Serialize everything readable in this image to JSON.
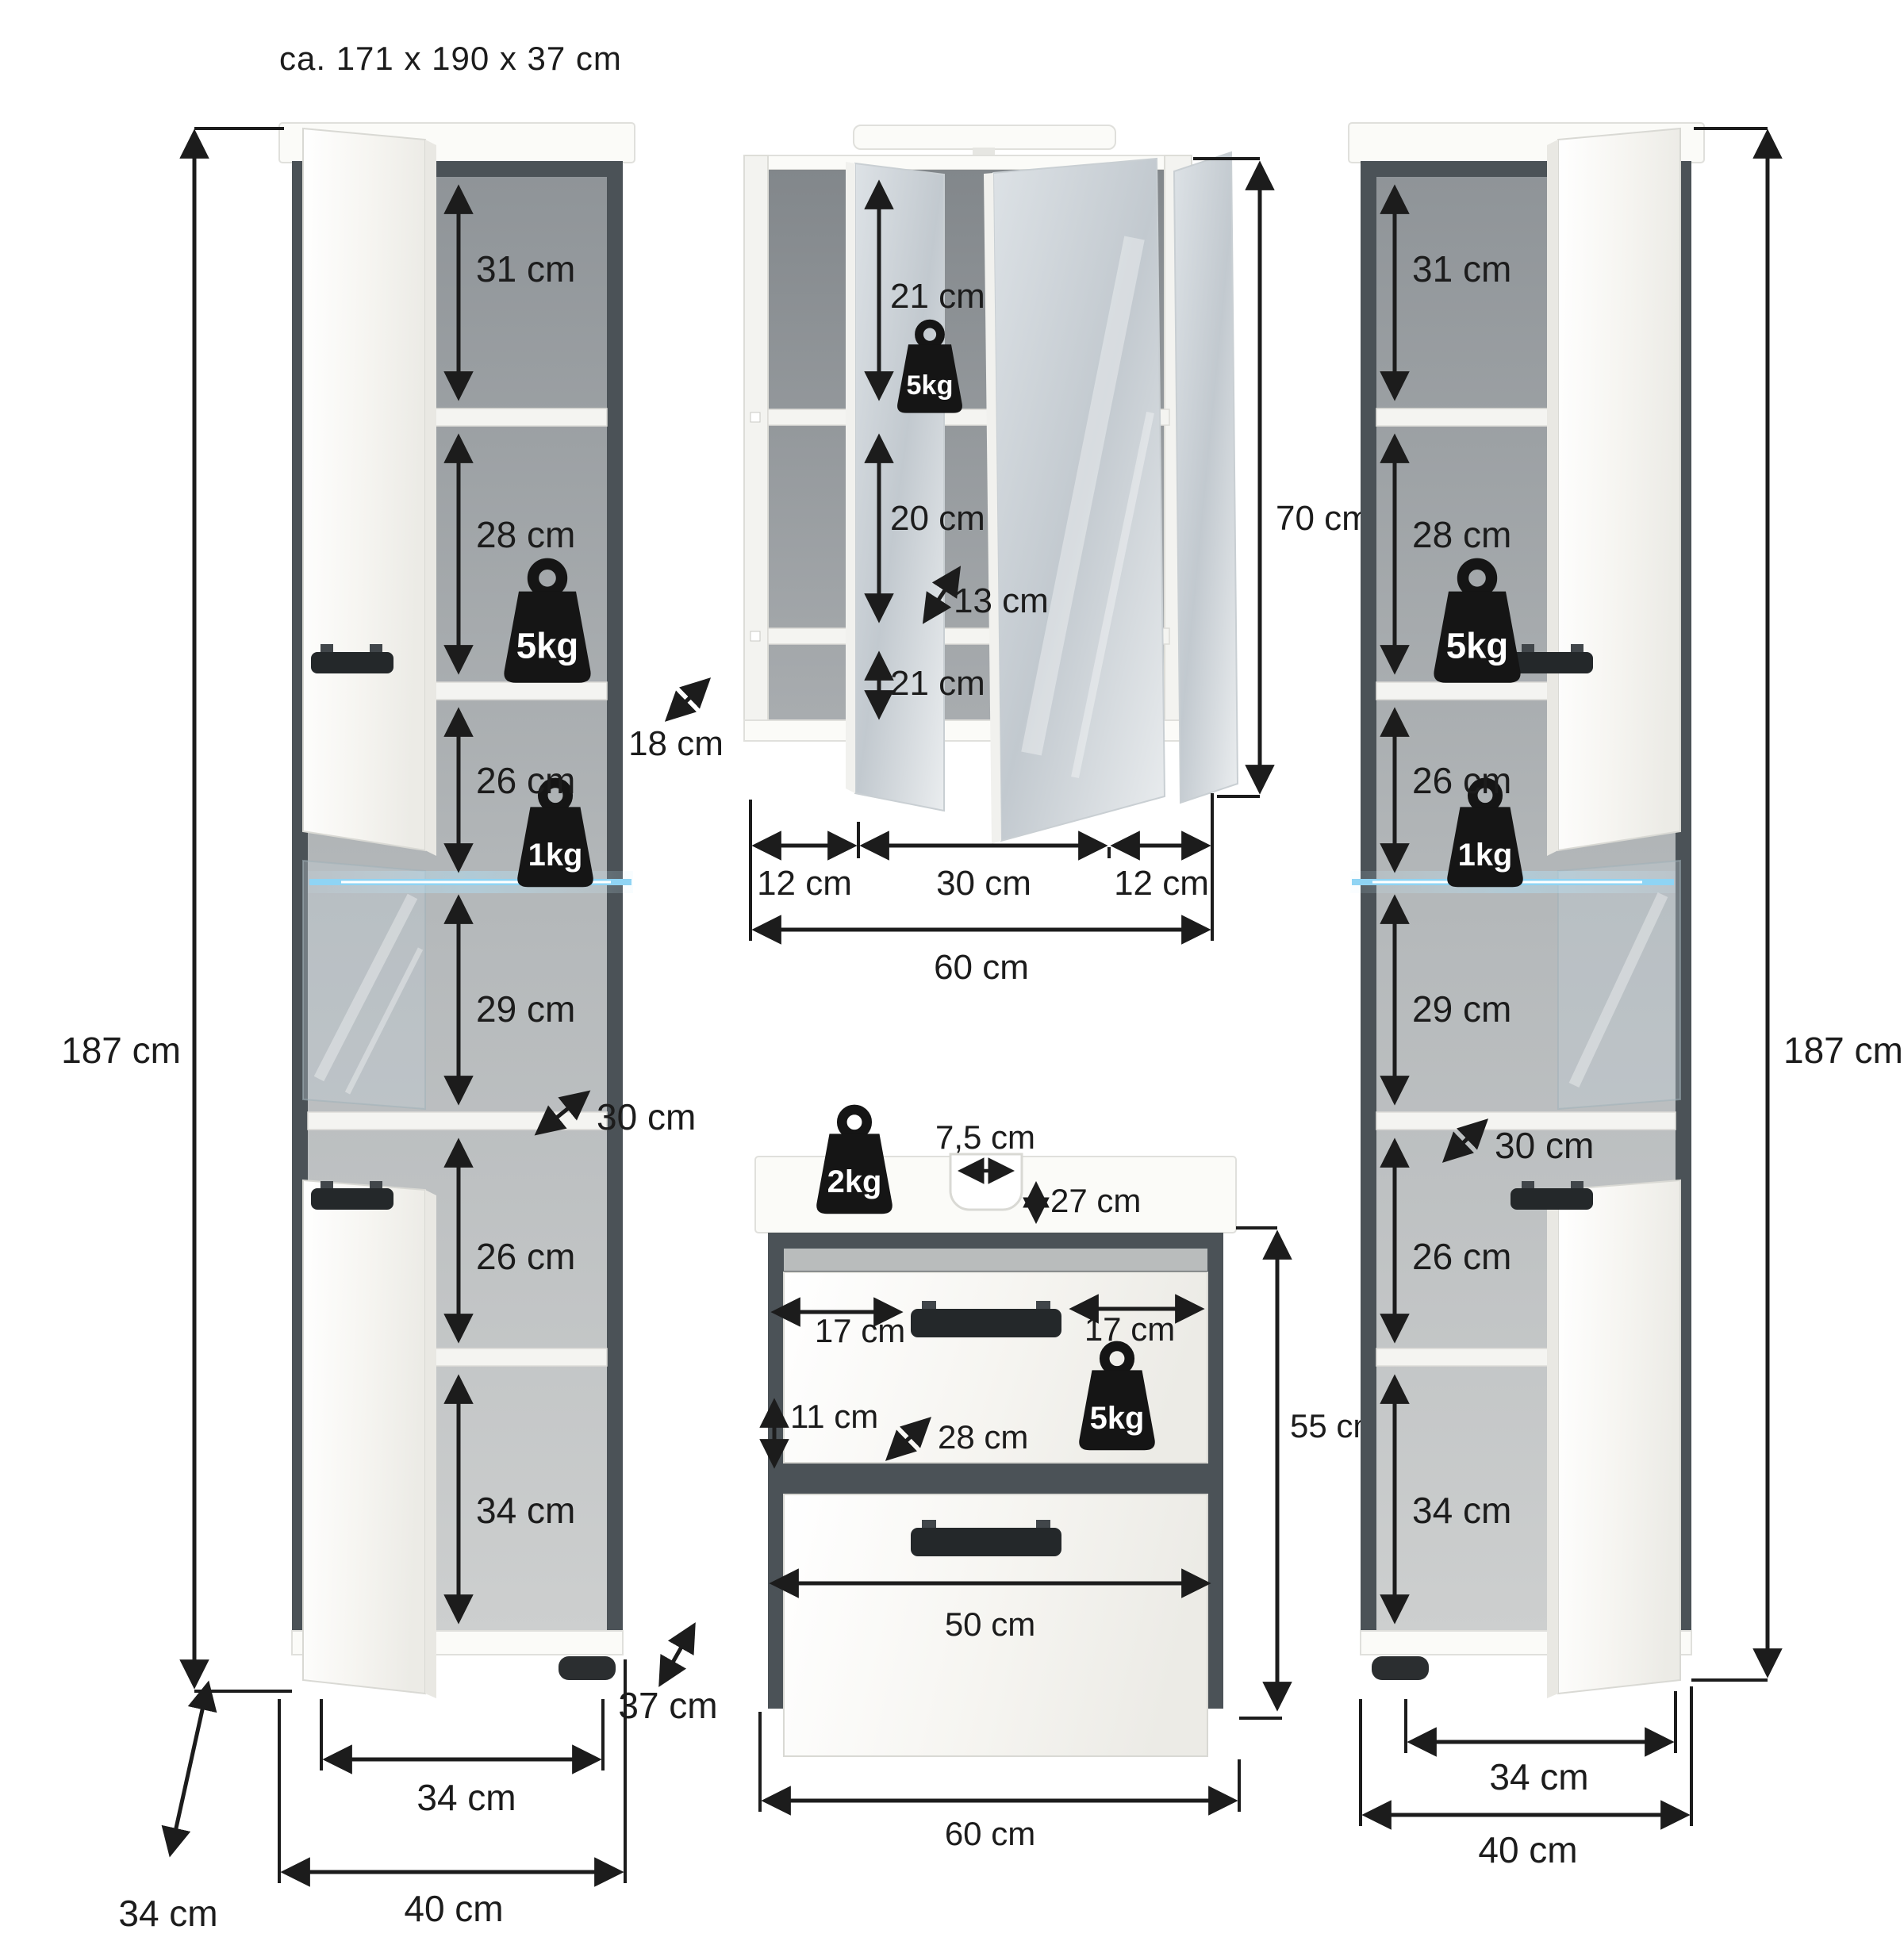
{
  "title": "ca. 171 x 190 x 37 cm",
  "tall_cabinet_left": {
    "height": "187 cm",
    "sections": [
      "31 cm",
      "28 cm",
      "26 cm",
      "29 cm",
      "26 cm",
      "34 cm"
    ],
    "weight_top": "5kg",
    "weight_glass": "1kg",
    "depth_inner": "30 cm",
    "depth_side": "34 cm",
    "depth_total": "37 cm",
    "width_inner": "34 cm",
    "width_total": "40 cm"
  },
  "tall_cabinet_right": {
    "height": "187 cm",
    "sections": [
      "31 cm",
      "28 cm",
      "26 cm",
      "29 cm",
      "26 cm",
      "34 cm"
    ],
    "weight_top": "5kg",
    "weight_glass": "1kg",
    "depth_inner": "30 cm",
    "width_inner": "34 cm",
    "width_total": "40 cm"
  },
  "mirror_cabinet": {
    "height": "70 cm",
    "sections": [
      "21 cm",
      "20 cm",
      "21 cm"
    ],
    "weight": "5kg",
    "depth_inner": "13 cm",
    "depth_side": "18 cm",
    "widths": [
      "12 cm",
      "30 cm",
      "12 cm"
    ],
    "width_total": "60 cm"
  },
  "sink_cabinet": {
    "weight_top": "2kg",
    "weight_front": "5kg",
    "hole_width": "7,5 cm",
    "hole_inset": "27 cm",
    "handle_left": "17 cm",
    "handle_right": "17 cm",
    "front_height": "11 cm",
    "depth_inner": "28 cm",
    "height": "55 cm",
    "drawer_width": "50 cm",
    "width_total": "60 cm"
  }
}
